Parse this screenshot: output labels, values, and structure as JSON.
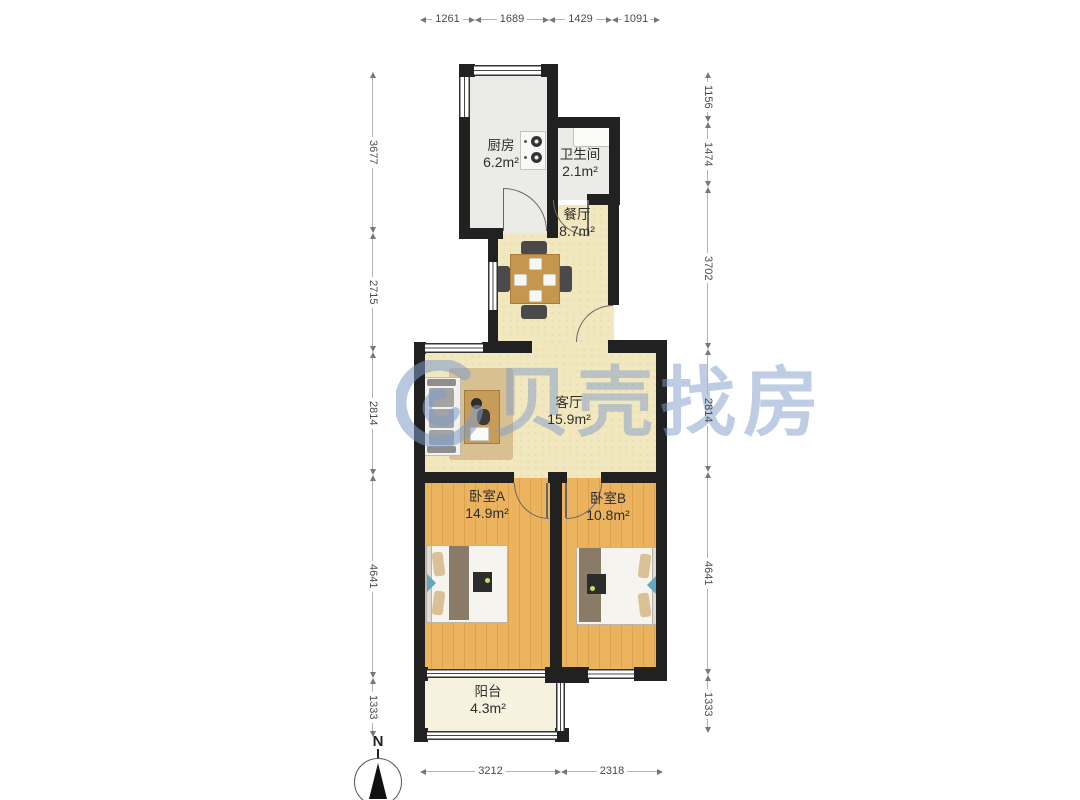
{
  "watermark": {
    "text": "贝壳找房",
    "logo": "beike-shell-logo"
  },
  "compass": {
    "label": "N"
  },
  "rooms": [
    {
      "id": "kitchen",
      "name": "厨房",
      "area": "6.2m²",
      "cx": 501,
      "top": 138
    },
    {
      "id": "bathroom",
      "name": "卫生间",
      "area": "2.1m²",
      "cx": 580,
      "top": 147
    },
    {
      "id": "dining",
      "name": "餐厅",
      "area": "8.7m²",
      "cx": 577,
      "top": 207
    },
    {
      "id": "living",
      "name": "客厅",
      "area": "15.9m²",
      "cx": 569,
      "top": 395
    },
    {
      "id": "bedroom-a",
      "name": "卧室A",
      "area": "14.9m²",
      "cx": 487,
      "top": 489
    },
    {
      "id": "bedroom-b",
      "name": "卧室B",
      "area": "10.8m²",
      "cx": 608,
      "top": 491
    },
    {
      "id": "balcony",
      "name": "阳台",
      "area": "4.3m²",
      "cx": 488,
      "top": 684
    }
  ],
  "dimensions": {
    "top": {
      "orientation": "h",
      "x": 420,
      "y": 13,
      "segments": [
        {
          "label": "1261",
          "len": 55
        },
        {
          "label": "1689",
          "len": 74
        },
        {
          "label": "1429",
          "len": 63
        },
        {
          "label": "1091",
          "len": 48
        }
      ]
    },
    "bottom": {
      "orientation": "h",
      "x": 420,
      "y": 765,
      "segments": [
        {
          "label": "3212",
          "len": 141
        },
        {
          "label": "2318",
          "len": 102
        }
      ]
    },
    "left": {
      "orientation": "v",
      "x": 365,
      "y": 72,
      "segments": [
        {
          "label": "3677",
          "len": 161
        },
        {
          "label": "2715",
          "len": 119
        },
        {
          "label": "2814",
          "len": 123
        },
        {
          "label": "4641",
          "len": 203
        },
        {
          "label": "1333",
          "len": 59
        }
      ]
    },
    "right": {
      "orientation": "v",
      "x": 700,
      "y": 72,
      "segments": [
        {
          "label": "1156",
          "len": 50
        },
        {
          "label": "1474",
          "len": 65
        },
        {
          "label": "3702",
          "len": 162
        },
        {
          "label": "2814",
          "len": 123
        },
        {
          "label": "4641",
          "len": 203
        },
        {
          "label": "1333",
          "len": 58
        }
      ]
    }
  },
  "colors": {
    "wall": "#212121",
    "wood_floor": "#ecb35f",
    "cream_floor": "#f2e8c0",
    "tile_floor": "#ebebe7",
    "balcony_floor": "#f6f2df",
    "watermark": "#7f9cc9",
    "dimension_text": "#4a4a4a"
  }
}
